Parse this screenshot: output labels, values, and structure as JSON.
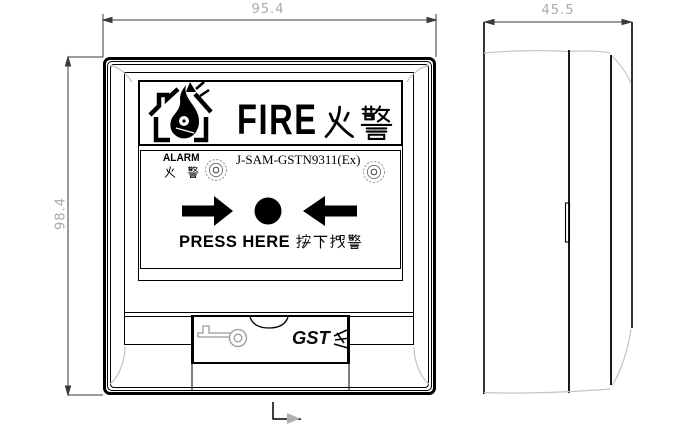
{
  "front_view": {
    "width_dim": "95.4",
    "height_dim": "98.4",
    "header": {
      "fire_en": "FIRE",
      "fire_cn": "火警"
    },
    "alarm": {
      "label_en": "ALARM",
      "label_cn": "火 警",
      "model": "J-SAM-GSTN9311(Ex)"
    },
    "press": {
      "label_en": "PRESS HERE",
      "label_cn": "按下报警"
    },
    "brand": "GST"
  },
  "side_view": {
    "depth_dim": "45.5"
  },
  "icons": {
    "house_fire": "burning-house",
    "screw": "screw-head",
    "arrow_right": "block-arrow-right",
    "arrow_left": "block-arrow-left",
    "press_button": "round-press-button",
    "key": "key-and-lock",
    "notch": "thumb-notch",
    "section_marker": "section-arrow"
  },
  "colors": {
    "line": "#000000",
    "dim_line": "#3a3a3a",
    "dim_text": "#aaaaaa",
    "bevel": "#c4c4c4",
    "icon_gray": "#9a9a9a"
  }
}
